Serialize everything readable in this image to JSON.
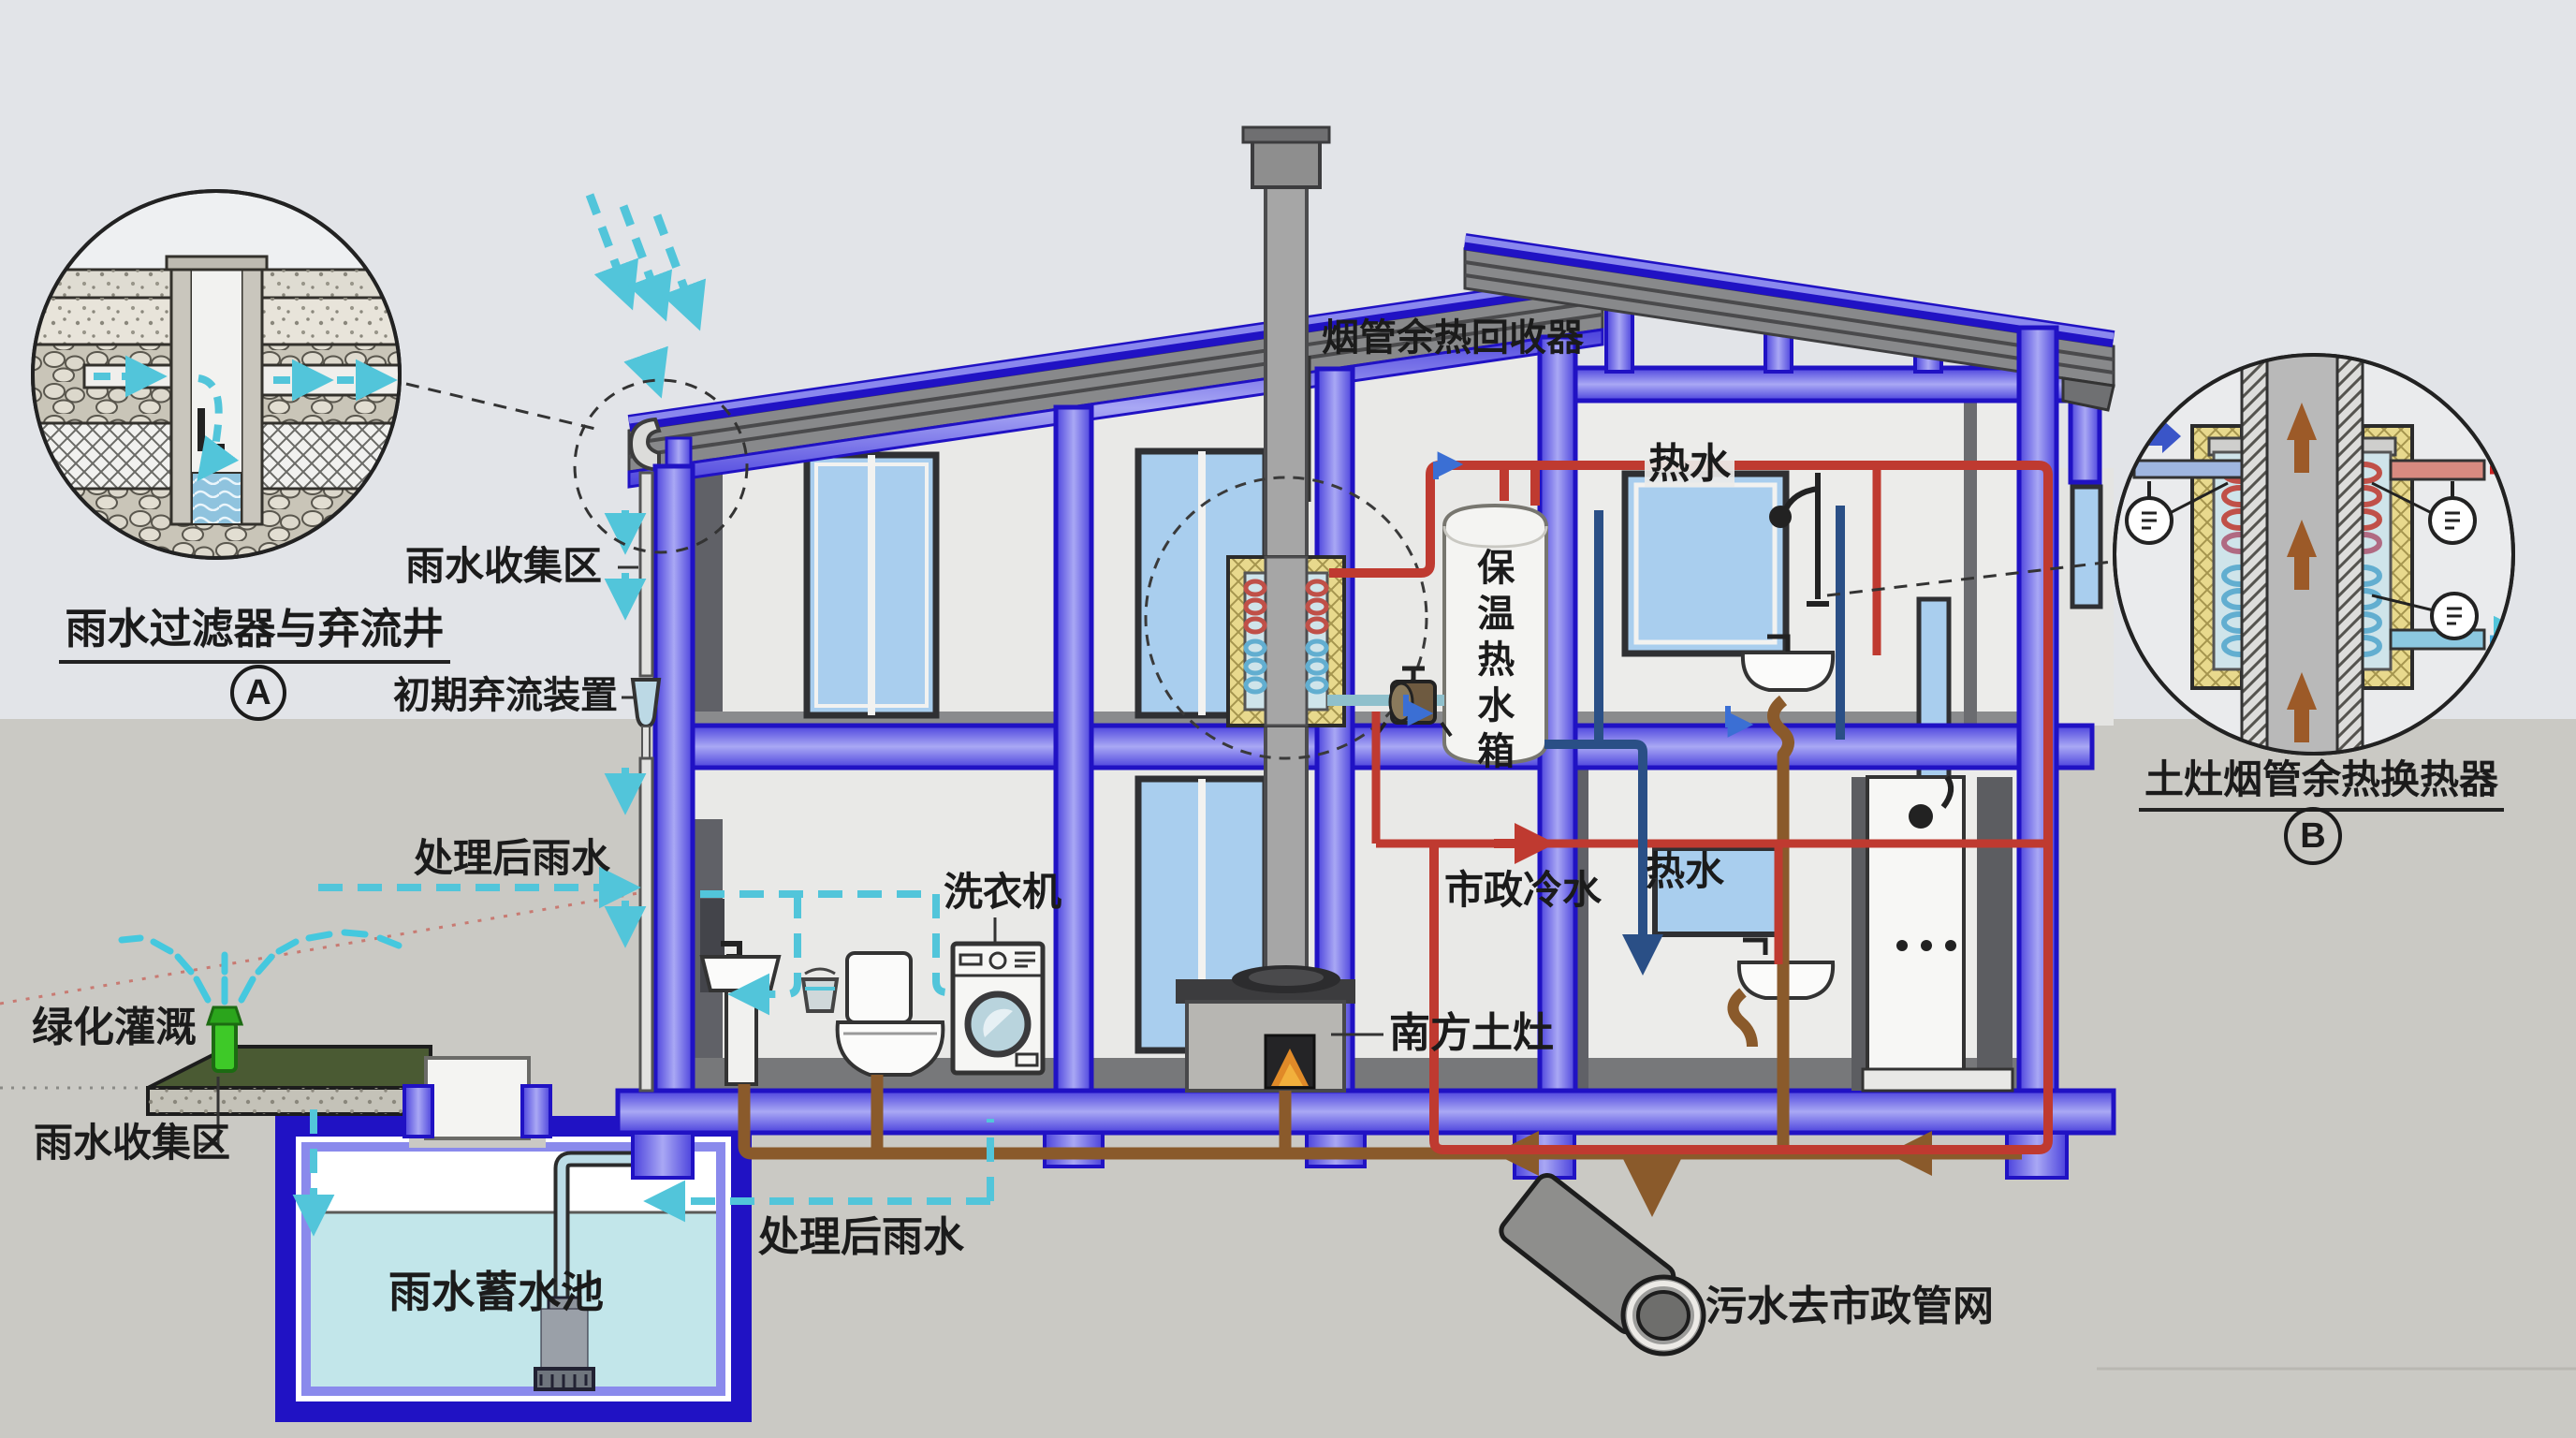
{
  "scene": {
    "background": "#e2e4e8",
    "ground_color": "#cac9c4",
    "structure_blue": "#2012c4",
    "structure_blue_light": "#8583ea",
    "hot_water_color": "#bf3a30",
    "cold_water_color": "#2a4f86",
    "treated_rain_color": "#52c5da",
    "sewage_color": "#8a5a2b"
  },
  "labels": {
    "flue_recovery": "烟管余热回收器",
    "hot_water_upper": "热水",
    "hot_water_lower": "热水",
    "tank_vertical": "保温热水箱",
    "municipal_cold": "市政冷水",
    "rain_collect_upper": "雨水收集区",
    "initial_diversion": "初期弃流装置",
    "treated_rain_left": "处理后雨水",
    "treated_rain_bottom": "处理后雨水",
    "green_irrigation": "绿化灌溉",
    "rain_collect_lower": "雨水收集区",
    "rain_tank": "雨水蓄水池",
    "washing_machine": "洗衣机",
    "south_stove": "南方土灶",
    "sewage_outlet": "污水去市政管网",
    "circle_a_title": "雨水过滤器与弃流井",
    "circle_a_badge": "A",
    "circle_b_title": "土灶烟管余热换热器",
    "circle_b_badge": "B"
  }
}
